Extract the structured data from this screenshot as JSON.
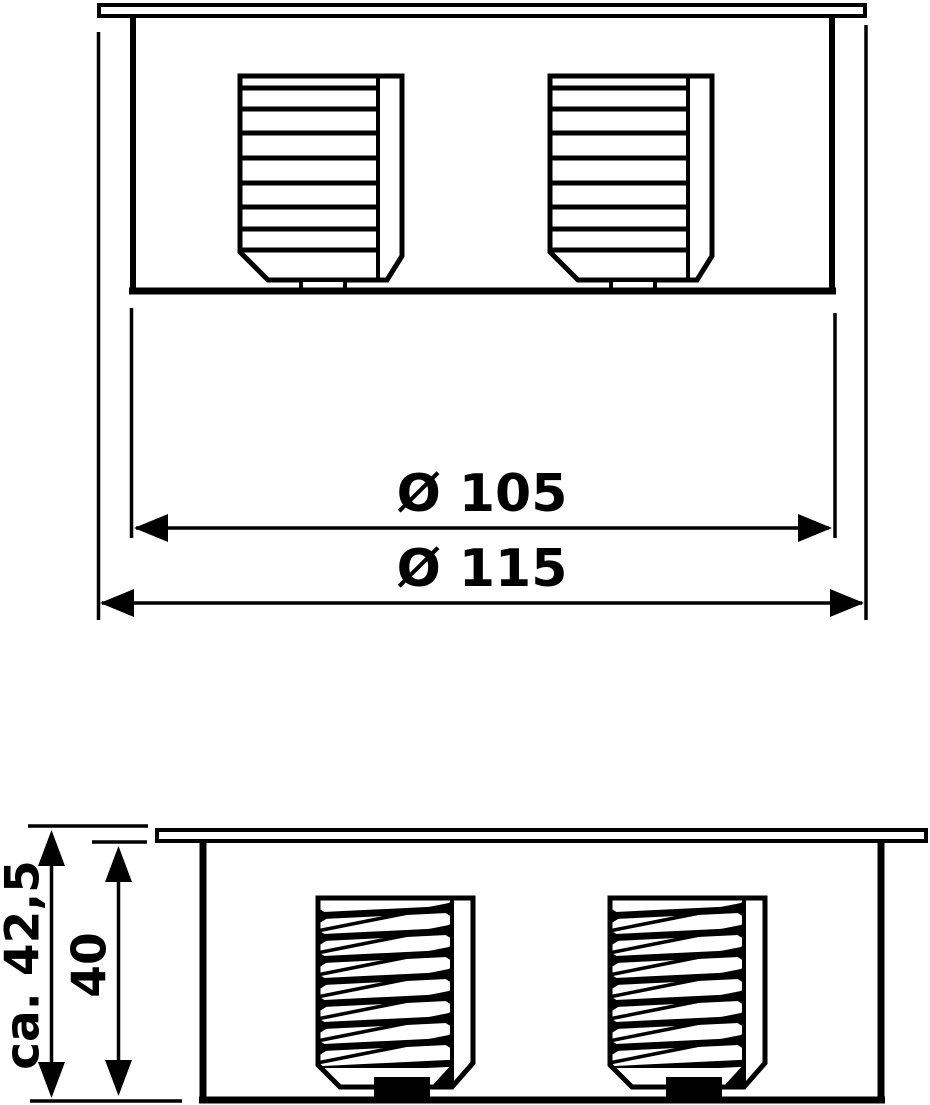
{
  "drawing": {
    "type": "technical-dimension-drawing",
    "background_color": "#ffffff",
    "line_color": "#000000",
    "top_view": {
      "inner_diameter_label": "Ø 105",
      "outer_diameter_label": "Ø 115"
    },
    "side_view": {
      "overall_height_label": "ca. 42,5",
      "recess_depth_label": "40"
    }
  }
}
